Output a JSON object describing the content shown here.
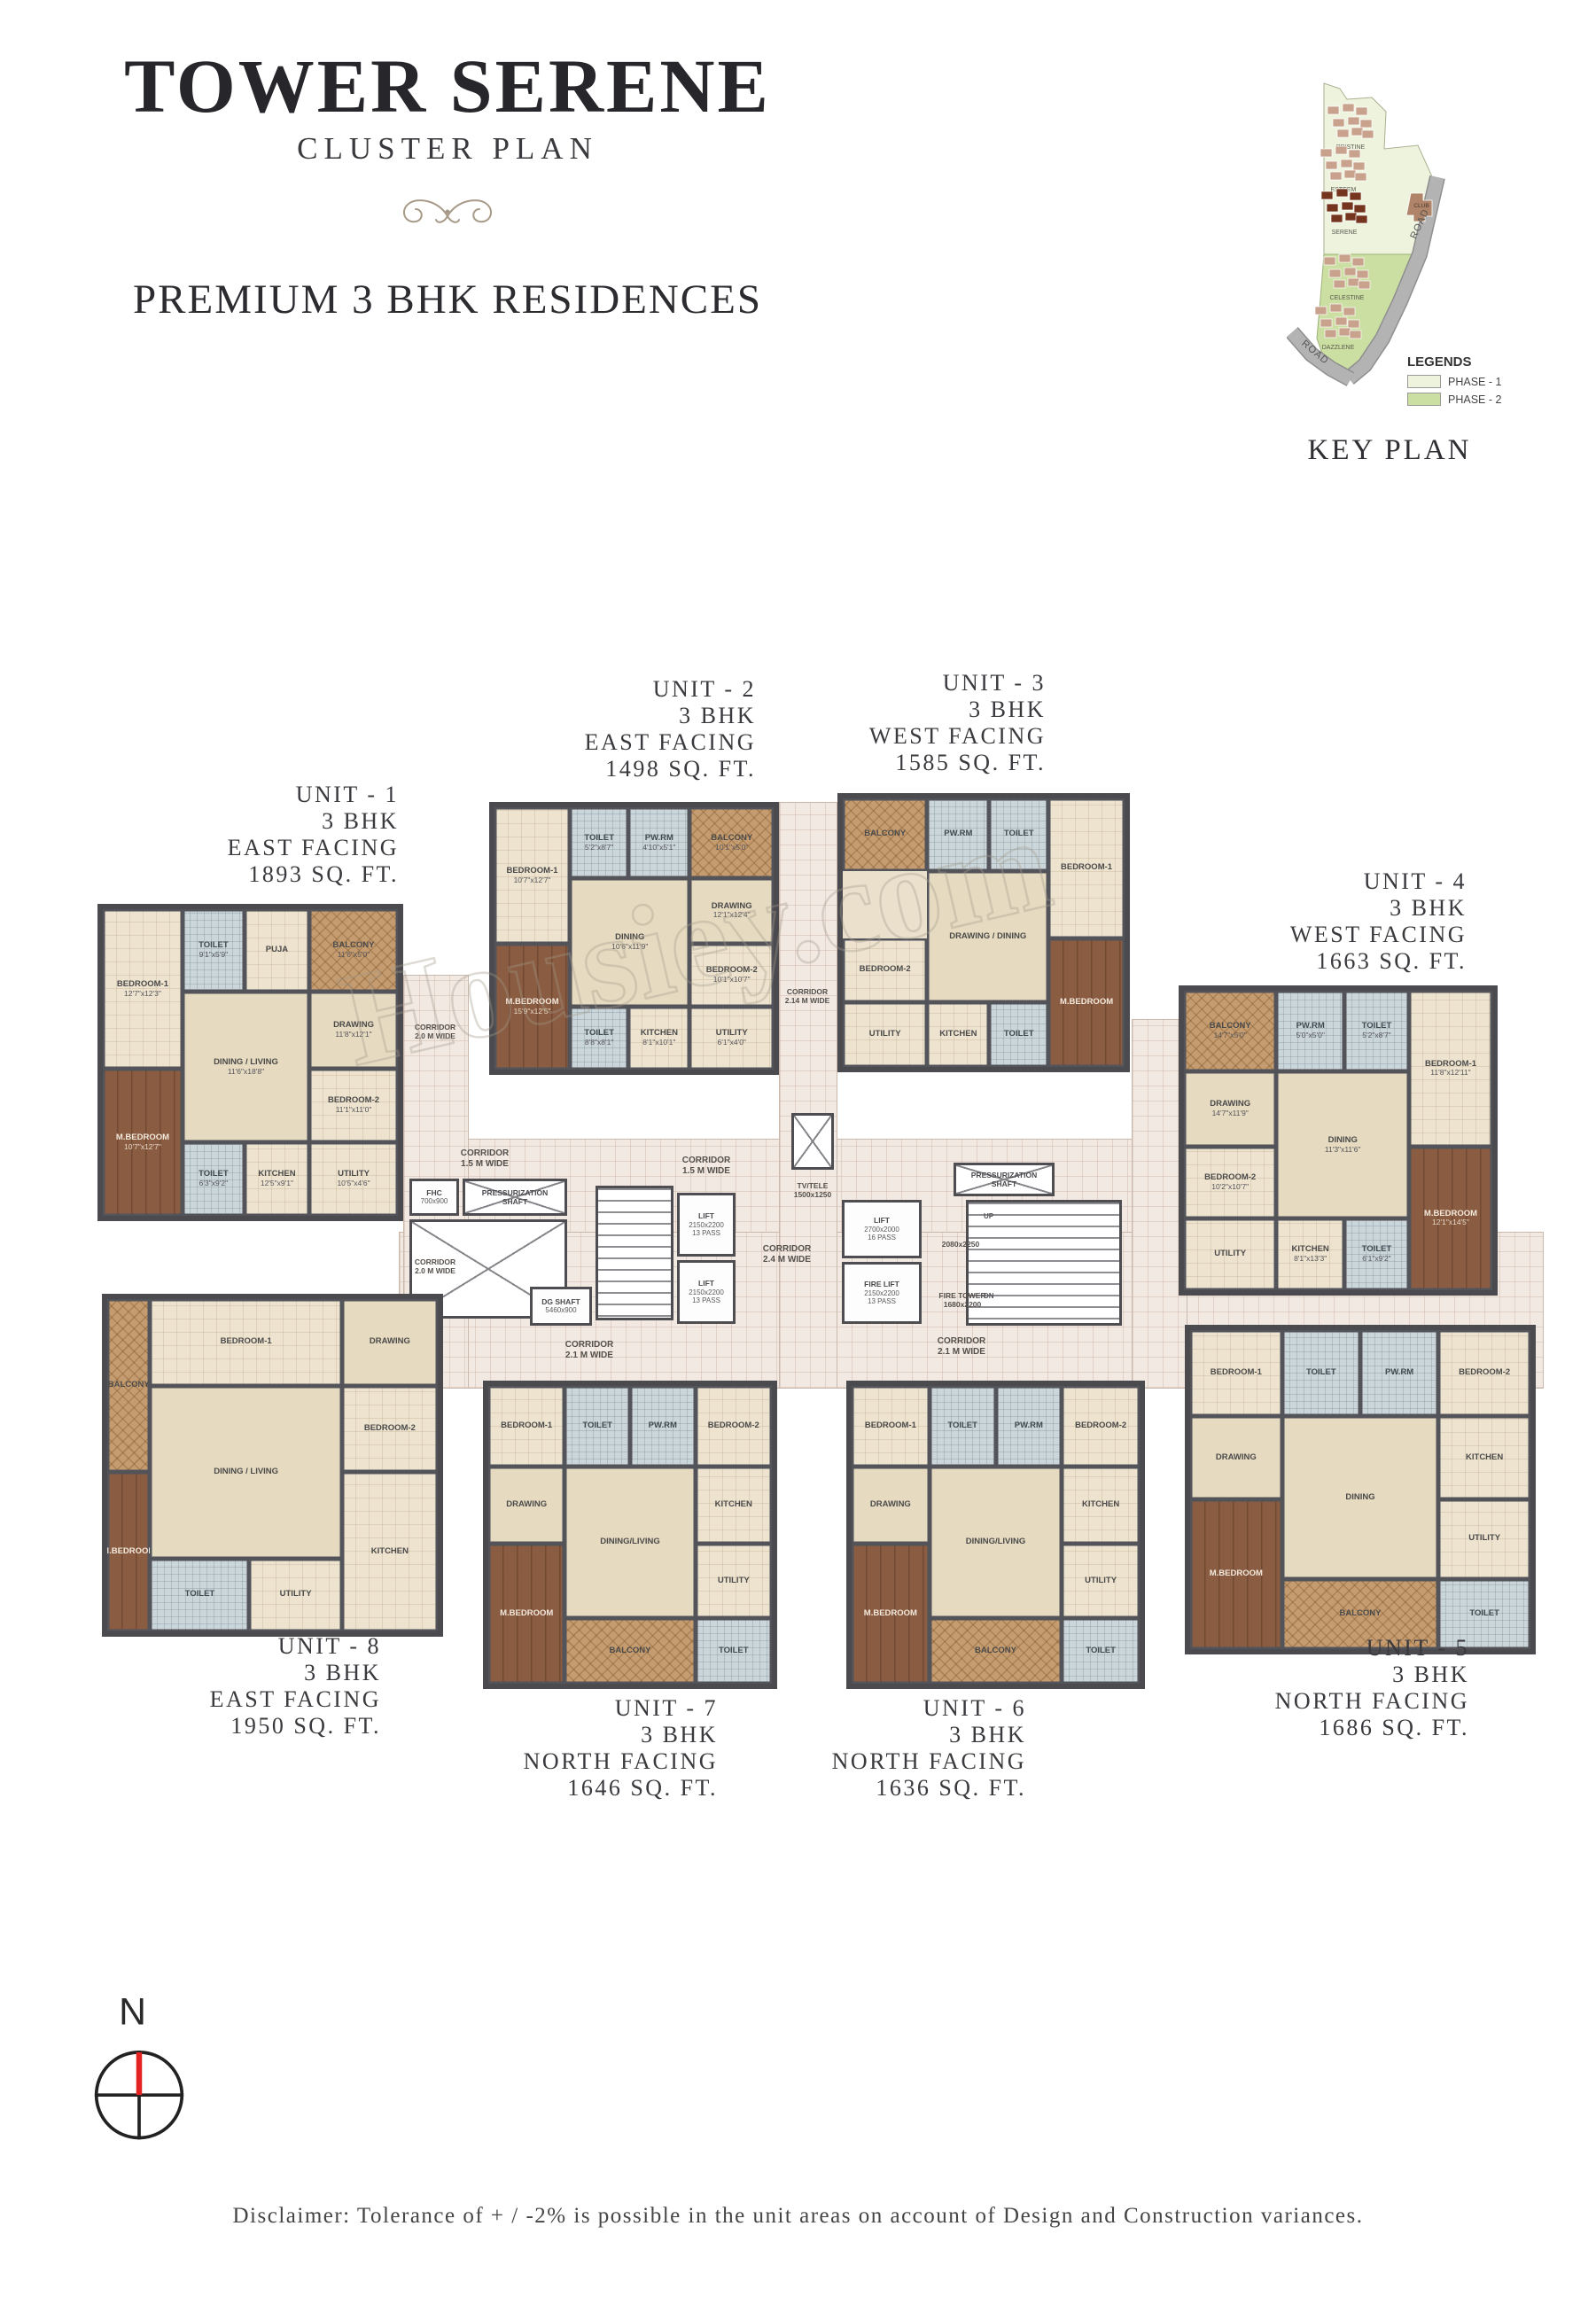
{
  "header": {
    "title": "TOWER SERENE",
    "subtitle": "CLUSTER PLAN",
    "tagline": "PREMIUM 3 BHK RESIDENCES"
  },
  "key_plan": {
    "title": "KEY PLAN",
    "legend_title": "LEGENDS",
    "legend": [
      {
        "label": "PHASE - 1",
        "color": "#eef3de"
      },
      {
        "label": "PHASE - 2",
        "color": "#cbdfa2"
      }
    ],
    "clusters": [
      {
        "name": "PRISTINE"
      },
      {
        "name": "ESTEEM"
      },
      {
        "name": "SERENE",
        "highlight": true
      },
      {
        "name": "CELESTINE"
      },
      {
        "name": "DAZZLENE"
      }
    ],
    "club_label": "CLUB",
    "road_label": "ROAD"
  },
  "palette": {
    "phase1": "#eef3de",
    "phase2": "#cbdfa2",
    "road": "#b3b3b3",
    "cluster": "#c9a28d",
    "serene_highlight": "#74341d",
    "wall": "#4a4a4f",
    "floor": "#eae0cc",
    "living": "#e6dac0",
    "toilet": "#cbd6db",
    "balcony": "#c59c6f",
    "master": "#8a5c41",
    "corridor": "#f1e9e2",
    "north_needle": "#e32222"
  },
  "units": [
    {
      "id": 1,
      "name": "UNIT - 1",
      "bhk": "3 BHK",
      "facing": "EAST FACING",
      "area": "1893 SQ. FT.",
      "rooms": [
        {
          "slot": "b1",
          "kind": "bed",
          "label": "BEDROOM-1",
          "dim": "12'7\"x12'3\""
        },
        {
          "slot": "t1",
          "kind": "toilet",
          "label": "TOILET",
          "dim": "9'1\"x5'9\""
        },
        {
          "slot": "pw",
          "kind": "puja",
          "label": "PUJA",
          "dim": ""
        },
        {
          "slot": "bal",
          "kind": "bal",
          "label": "BALCONY",
          "dim": "11'6\"x5'0\""
        },
        {
          "slot": "dr",
          "kind": "liv",
          "label": "DRAWING",
          "dim": "11'8\"x12'1\""
        },
        {
          "slot": "liv",
          "kind": "liv",
          "label": "DINING / LIVING",
          "dim": "11'6\"x18'8\""
        },
        {
          "slot": "b2",
          "kind": "bed",
          "label": "BEDROOM-2",
          "dim": "11'1\"x11'0\""
        },
        {
          "slot": "m",
          "kind": "master",
          "label": "M.BEDROOM",
          "dim": "10'7\"x12'7\""
        },
        {
          "slot": "t2",
          "kind": "toilet",
          "label": "TOILET",
          "dim": "6'3\"x9'2\""
        },
        {
          "slot": "k",
          "kind": "kitchen",
          "label": "KITCHEN",
          "dim": "12'5\"x9'1\""
        },
        {
          "slot": "u",
          "kind": "util",
          "label": "UTILITY",
          "dim": "10'5\"x4'6\""
        }
      ]
    },
    {
      "id": 2,
      "name": "UNIT - 2",
      "bhk": "3 BHK",
      "facing": "EAST FACING",
      "area": "1498 SQ. FT.",
      "rooms": [
        {
          "slot": "b1",
          "kind": "bed",
          "label": "BEDROOM-1",
          "dim": "10'7\"x12'7\""
        },
        {
          "slot": "t1",
          "kind": "toilet",
          "label": "TOILET",
          "dim": "5'2\"x8'7\""
        },
        {
          "slot": "pw",
          "kind": "pw",
          "label": "PW.RM",
          "dim": "4'10\"x5'1\""
        },
        {
          "slot": "bal",
          "kind": "bal",
          "label": "BALCONY",
          "dim": "10'1\"x5'0\""
        },
        {
          "slot": "dr",
          "kind": "liv",
          "label": "DRAWING",
          "dim": "12'1\"x12'4\""
        },
        {
          "slot": "liv",
          "kind": "liv",
          "label": "DINING",
          "dim": "10'6\"x11'9\""
        },
        {
          "slot": "b2",
          "kind": "bed",
          "label": "BEDROOM-2",
          "dim": "10'1\"x10'7\""
        },
        {
          "slot": "m",
          "kind": "master",
          "label": "M.BEDROOM",
          "dim": "15'9\"x12'5\""
        },
        {
          "slot": "t2",
          "kind": "toilet",
          "label": "TOILET",
          "dim": "8'8\"x8'1\""
        },
        {
          "slot": "k",
          "kind": "kitchen",
          "label": "KITCHEN",
          "dim": "8'1\"x10'1\""
        },
        {
          "slot": "u",
          "kind": "util",
          "label": "UTILITY",
          "dim": "6'1\"x4'0\""
        }
      ]
    },
    {
      "id": 3,
      "name": "UNIT - 3",
      "bhk": "3 BHK",
      "facing": "WEST FACING",
      "area": "1585 SQ. FT.",
      "rooms": [
        {
          "slot": "b1",
          "kind": "bed",
          "label": "BEDROOM-1",
          "dim": ""
        },
        {
          "slot": "t1",
          "kind": "toilet",
          "label": "TOILET",
          "dim": ""
        },
        {
          "slot": "pw",
          "kind": "pw",
          "label": "PW.RM",
          "dim": ""
        },
        {
          "slot": "bal",
          "kind": "bal",
          "label": "BALCONY",
          "dim": ""
        },
        {
          "slot": "liv",
          "kind": "liv",
          "label": "DRAWING / DINING",
          "dim": ""
        },
        {
          "slot": "b2",
          "kind": "bed",
          "label": "BEDROOM-2",
          "dim": ""
        },
        {
          "slot": "m",
          "kind": "master",
          "label": "M.BEDROOM",
          "dim": ""
        },
        {
          "slot": "t2",
          "kind": "toilet",
          "label": "TOILET",
          "dim": ""
        },
        {
          "slot": "k",
          "kind": "kitchen",
          "label": "KITCHEN",
          "dim": ""
        },
        {
          "slot": "u",
          "kind": "util",
          "label": "UTILITY",
          "dim": ""
        }
      ]
    },
    {
      "id": 4,
      "name": "UNIT - 4",
      "bhk": "3 BHK",
      "facing": "WEST FACING",
      "area": "1663 SQ. FT.",
      "rooms": [
        {
          "slot": "bal",
          "kind": "bal",
          "label": "BALCONY",
          "dim": "14'7\"x5'0\""
        },
        {
          "slot": "pw",
          "kind": "pw",
          "label": "PW.RM",
          "dim": "5'0\"x5'0\""
        },
        {
          "slot": "t1",
          "kind": "toilet",
          "label": "TOILET",
          "dim": "5'2\"x8'7\""
        },
        {
          "slot": "b1",
          "kind": "bed",
          "label": "BEDROOM-1",
          "dim": "11'8\"x12'11\""
        },
        {
          "slot": "dr",
          "kind": "liv",
          "label": "DRAWING",
          "dim": "14'7\"x11'9\""
        },
        {
          "slot": "liv",
          "kind": "liv",
          "label": "DINING",
          "dim": "11'3\"x11'6\""
        },
        {
          "slot": "b2",
          "kind": "bed",
          "label": "BEDROOM-2",
          "dim": "10'2\"x10'7\""
        },
        {
          "slot": "m",
          "kind": "master",
          "label": "M.BEDROOM",
          "dim": "12'1\"x14'5\""
        },
        {
          "slot": "t2",
          "kind": "toilet",
          "label": "TOILET",
          "dim": "6'1\"x9'2\""
        },
        {
          "slot": "k",
          "kind": "kitchen",
          "label": "KITCHEN",
          "dim": "8'1\"x13'3\""
        },
        {
          "slot": "u",
          "kind": "util",
          "label": "UTILITY",
          "dim": ""
        }
      ]
    },
    {
      "id": 5,
      "name": "UNIT - 5",
      "bhk": "3 BHK",
      "facing": "NORTH FACING",
      "area": "1686 SQ. FT.",
      "rooms": [
        {
          "slot": "b1",
          "kind": "bed",
          "label": "BEDROOM-1",
          "dim": ""
        },
        {
          "slot": "t1",
          "kind": "toilet",
          "label": "TOILET",
          "dim": ""
        },
        {
          "slot": "pw",
          "kind": "pw",
          "label": "PW.RM",
          "dim": ""
        },
        {
          "slot": "b2",
          "kind": "bed",
          "label": "BEDROOM-2",
          "dim": ""
        },
        {
          "slot": "dr",
          "kind": "liv",
          "label": "DRAWING",
          "dim": ""
        },
        {
          "slot": "liv",
          "kind": "liv",
          "label": "DINING",
          "dim": ""
        },
        {
          "slot": "k",
          "kind": "kitchen",
          "label": "KITCHEN",
          "dim": ""
        },
        {
          "slot": "m",
          "kind": "master",
          "label": "M.BEDROOM",
          "dim": ""
        },
        {
          "slot": "u",
          "kind": "util",
          "label": "UTILITY",
          "dim": ""
        },
        {
          "slot": "bal",
          "kind": "bal",
          "label": "BALCONY",
          "dim": ""
        },
        {
          "slot": "t2",
          "kind": "toilet",
          "label": "TOILET",
          "dim": ""
        }
      ]
    },
    {
      "id": 6,
      "name": "UNIT - 6",
      "bhk": "3 BHK",
      "facing": "NORTH FACING",
      "area": "1636 SQ. FT.",
      "rooms": [
        {
          "slot": "b1",
          "kind": "bed",
          "label": "BEDROOM-1",
          "dim": ""
        },
        {
          "slot": "t1",
          "kind": "toilet",
          "label": "TOILET",
          "dim": ""
        },
        {
          "slot": "pw",
          "kind": "pw",
          "label": "PW.RM",
          "dim": ""
        },
        {
          "slot": "b2",
          "kind": "bed",
          "label": "BEDROOM-2",
          "dim": ""
        },
        {
          "slot": "dr",
          "kind": "liv",
          "label": "DRAWING",
          "dim": ""
        },
        {
          "slot": "liv",
          "kind": "liv",
          "label": "DINING/LIVING",
          "dim": ""
        },
        {
          "slot": "k",
          "kind": "kitchen",
          "label": "KITCHEN",
          "dim": ""
        },
        {
          "slot": "m",
          "kind": "master",
          "label": "M.BEDROOM",
          "dim": ""
        },
        {
          "slot": "u",
          "kind": "util",
          "label": "UTILITY",
          "dim": ""
        },
        {
          "slot": "bal",
          "kind": "bal",
          "label": "BALCONY",
          "dim": ""
        },
        {
          "slot": "t2",
          "kind": "toilet",
          "label": "TOILET",
          "dim": ""
        }
      ]
    },
    {
      "id": 7,
      "name": "UNIT - 7",
      "bhk": "3 BHK",
      "facing": "NORTH FACING",
      "area": "1646 SQ. FT.",
      "rooms": [
        {
          "slot": "b1",
          "kind": "bed",
          "label": "BEDROOM-1",
          "dim": ""
        },
        {
          "slot": "t1",
          "kind": "toilet",
          "label": "TOILET",
          "dim": ""
        },
        {
          "slot": "pw",
          "kind": "pw",
          "label": "PW.RM",
          "dim": ""
        },
        {
          "slot": "b2",
          "kind": "bed",
          "label": "BEDROOM-2",
          "dim": ""
        },
        {
          "slot": "dr",
          "kind": "liv",
          "label": "DRAWING",
          "dim": ""
        },
        {
          "slot": "liv",
          "kind": "liv",
          "label": "DINING/LIVING",
          "dim": ""
        },
        {
          "slot": "k",
          "kind": "kitchen",
          "label": "KITCHEN",
          "dim": ""
        },
        {
          "slot": "m",
          "kind": "master",
          "label": "M.BEDROOM",
          "dim": ""
        },
        {
          "slot": "u",
          "kind": "util",
          "label": "UTILITY",
          "dim": ""
        },
        {
          "slot": "bal",
          "kind": "bal",
          "label": "BALCONY",
          "dim": ""
        },
        {
          "slot": "t2",
          "kind": "toilet",
          "label": "TOILET",
          "dim": ""
        }
      ]
    },
    {
      "id": 8,
      "name": "UNIT - 8",
      "bhk": "3 BHK",
      "facing": "EAST FACING",
      "area": "1950 SQ. FT.",
      "rooms": [
        {
          "slot": "bal",
          "kind": "bal",
          "label": "BALCONY",
          "dim": ""
        },
        {
          "slot": "b1",
          "kind": "bed",
          "label": "BEDROOM-1",
          "dim": ""
        },
        {
          "slot": "dr",
          "kind": "liv",
          "label": "DRAWING",
          "dim": ""
        },
        {
          "slot": "liv",
          "kind": "liv",
          "label": "DINING / LIVING",
          "dim": ""
        },
        {
          "slot": "b2",
          "kind": "bed",
          "label": "BEDROOM-2",
          "dim": ""
        },
        {
          "slot": "m",
          "kind": "master",
          "label": "M.BEDROOM",
          "dim": ""
        },
        {
          "slot": "t2",
          "kind": "toilet",
          "label": "TOILET",
          "dim": ""
        },
        {
          "slot": "u",
          "kind": "util",
          "label": "UTILITY",
          "dim": ""
        },
        {
          "slot": "k",
          "kind": "kitchen",
          "label": "KITCHEN",
          "dim": ""
        }
      ]
    }
  ],
  "core": {
    "corridors": {
      "c15": "CORRIDOR\n1.5 M WIDE",
      "c24": "CORRIDOR\n2.4 M WIDE",
      "c21": "CORRIDOR\n2.1 M WIDE",
      "c20": "CORRIDOR\n2.0 M WIDE",
      "c214": "CORRIDOR\n2.14 M WIDE",
      "plain": "CORRIDOR"
    },
    "rooms": {
      "fhc": {
        "label": "FHC",
        "dim": "700x900"
      },
      "press": {
        "label": "PRESSURIZATION\nSHAFT"
      },
      "dg": {
        "label": "DG SHAFT",
        "dim": "5460x900"
      },
      "lift13": {
        "label": "LIFT",
        "dim": "2150x2200",
        "cap": "13 PASS"
      },
      "lift16": {
        "label": "LIFT",
        "dim": "2700x2000",
        "cap": "16 PASS"
      },
      "firelift": {
        "label": "FIRE LIFT",
        "dim": "2150x2200",
        "cap": "13 PASS"
      },
      "firetower": {
        "label": "FIRE TOWER",
        "dim": "1680x2200"
      },
      "tvtele": {
        "label": "TV/TELE",
        "dim": "1500x1250"
      },
      "dim2080": {
        "label": "2080x2250"
      }
    },
    "stairs": {
      "up": "UP",
      "dn": "DN"
    }
  },
  "compass": {
    "north_label": "N"
  },
  "watermark": "Housiey.com",
  "disclaimer": "Disclaimer: Tolerance of + / -2% is possible in the unit areas on account of Design and Construction variances."
}
